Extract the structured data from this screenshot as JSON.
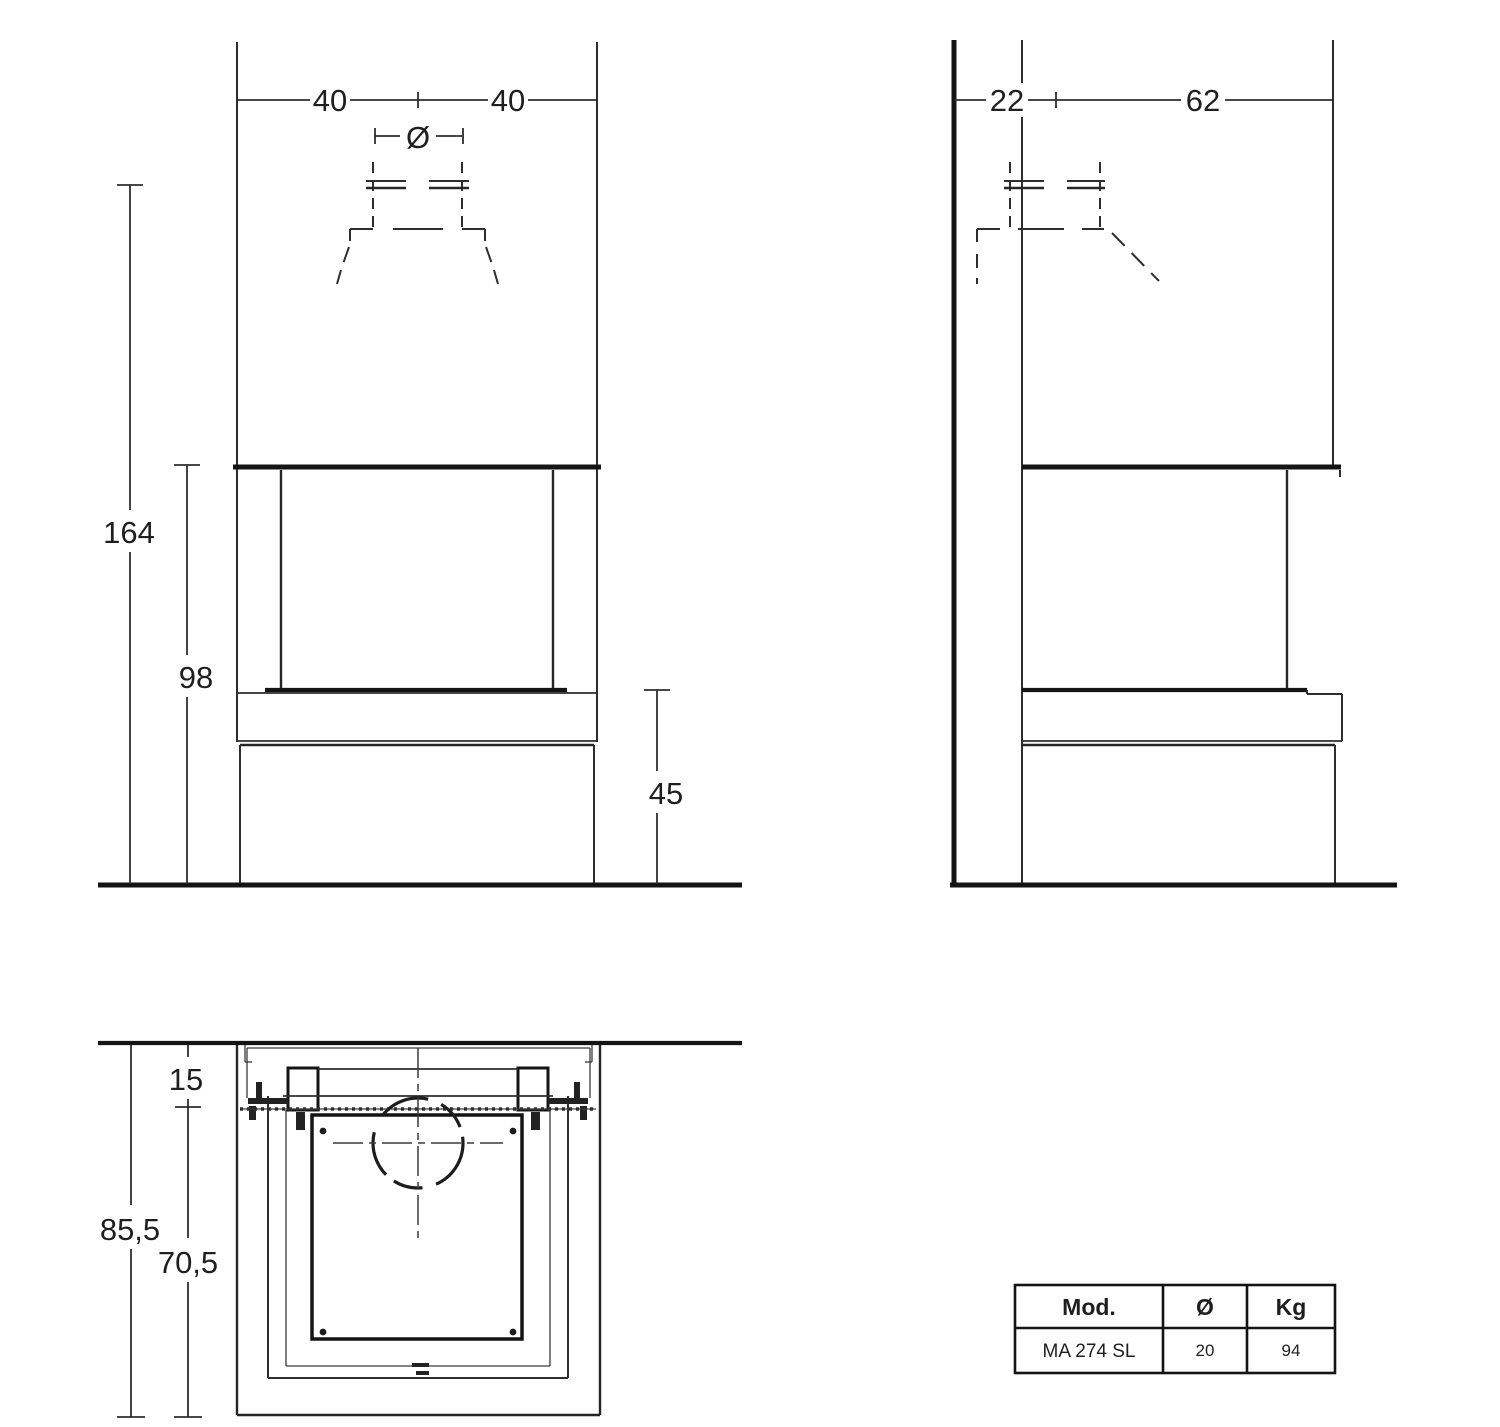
{
  "views": {
    "front": {
      "dims": {
        "width_left": "40",
        "width_right": "40",
        "flue_diameter_symbol": "Ø",
        "height_total": "164",
        "height_opening": "98",
        "height_bench": "45"
      }
    },
    "side": {
      "dims": {
        "wall_to_flue": "22",
        "flue_to_front": "62"
      }
    },
    "plan": {
      "dims": {
        "wall_gap": "15",
        "depth_total": "85,5",
        "depth_body": "70,5"
      }
    }
  },
  "spec_table": {
    "headers": [
      "Mod.",
      "Ø",
      "Kg"
    ],
    "rows": [
      [
        "MA 274 SL",
        "20",
        "94"
      ]
    ]
  },
  "colors": {
    "line": "#2e2e2e",
    "line_heavy": "#141414",
    "background": "#ffffff"
  }
}
